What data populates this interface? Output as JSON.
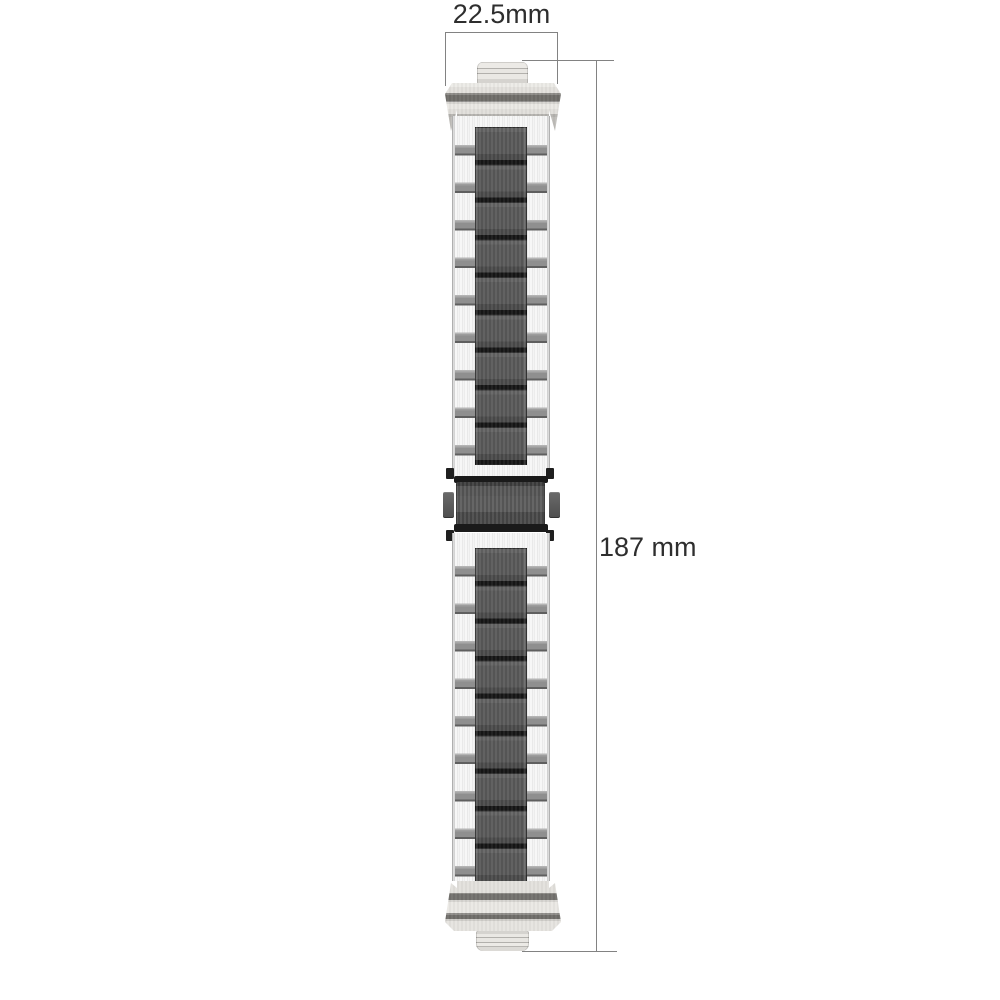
{
  "dims": {
    "width_label": "22.5mm",
    "height_label": "187 mm"
  },
  "colors": {
    "background": "#ffffff",
    "dimension_line": "#828282",
    "label_text": "#2e2e2e",
    "silver_link": "#efefef",
    "side_link_bar": "#8e8e8e",
    "dark_center_link": "#555555",
    "link_separator": "#161616",
    "connector_body": "#e9e7e3",
    "connector_stripe": "#6f6d69",
    "clasp_bar": "#1a1a1a",
    "clasp_body": "#4f4f4f"
  }
}
